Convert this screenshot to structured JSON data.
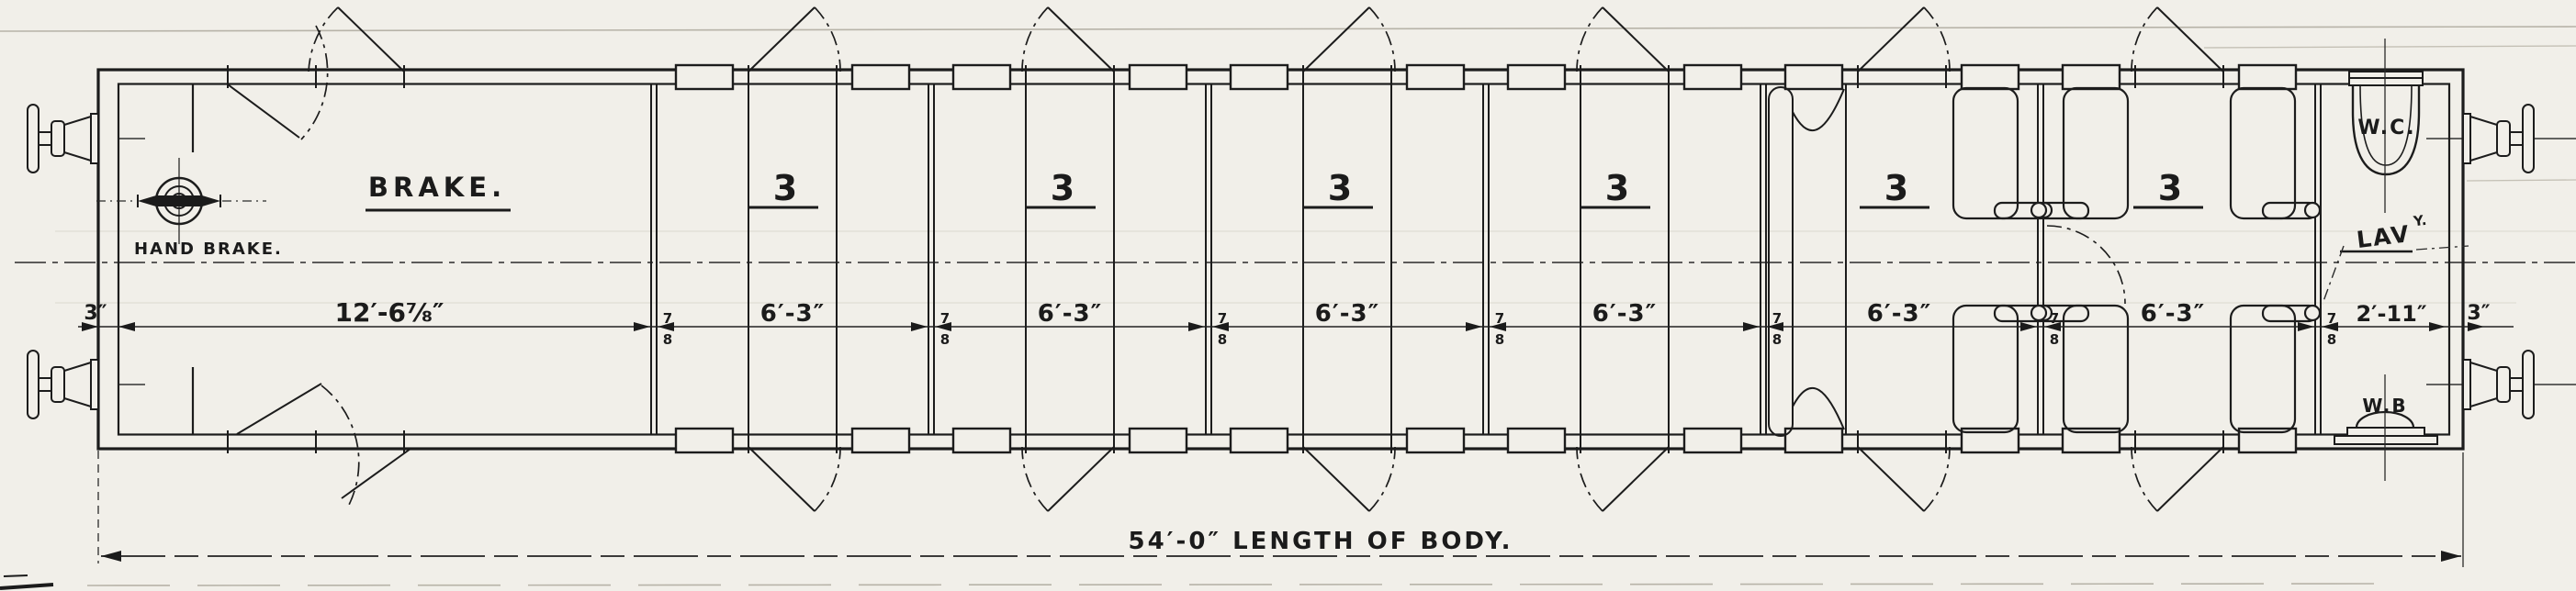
{
  "drawing": {
    "type": "railway-carriage-floor-plan",
    "paper_color": "#f1efe9",
    "ink_color": "#1b1b1b"
  },
  "labels": {
    "brake": "BRAKE.",
    "hand_brake": "HAND BRAKE.",
    "wc": "W.C.",
    "lav": "LAV",
    "lav_superscript": "Y.",
    "wb": "W.B"
  },
  "compartments": [
    {
      "class_label": "3",
      "width": "6′-3″"
    },
    {
      "class_label": "3",
      "width": "6′-3″"
    },
    {
      "class_label": "3",
      "width": "6′-3″"
    },
    {
      "class_label": "3",
      "width": "6′-3″"
    },
    {
      "class_label": "3",
      "width": "6′-3″"
    },
    {
      "class_label": "3",
      "width": "6′-3″"
    }
  ],
  "dimensions": {
    "end_wall": "3″",
    "brake_compartment": "12′-6⅞″",
    "partition": "⅞″",
    "partition_numerator": "7",
    "partition_denominator": "8",
    "compartment_width": "6′-3″",
    "lavatory": "2′-11″",
    "body_length": "54′-0″ LENGTH OF BODY."
  }
}
